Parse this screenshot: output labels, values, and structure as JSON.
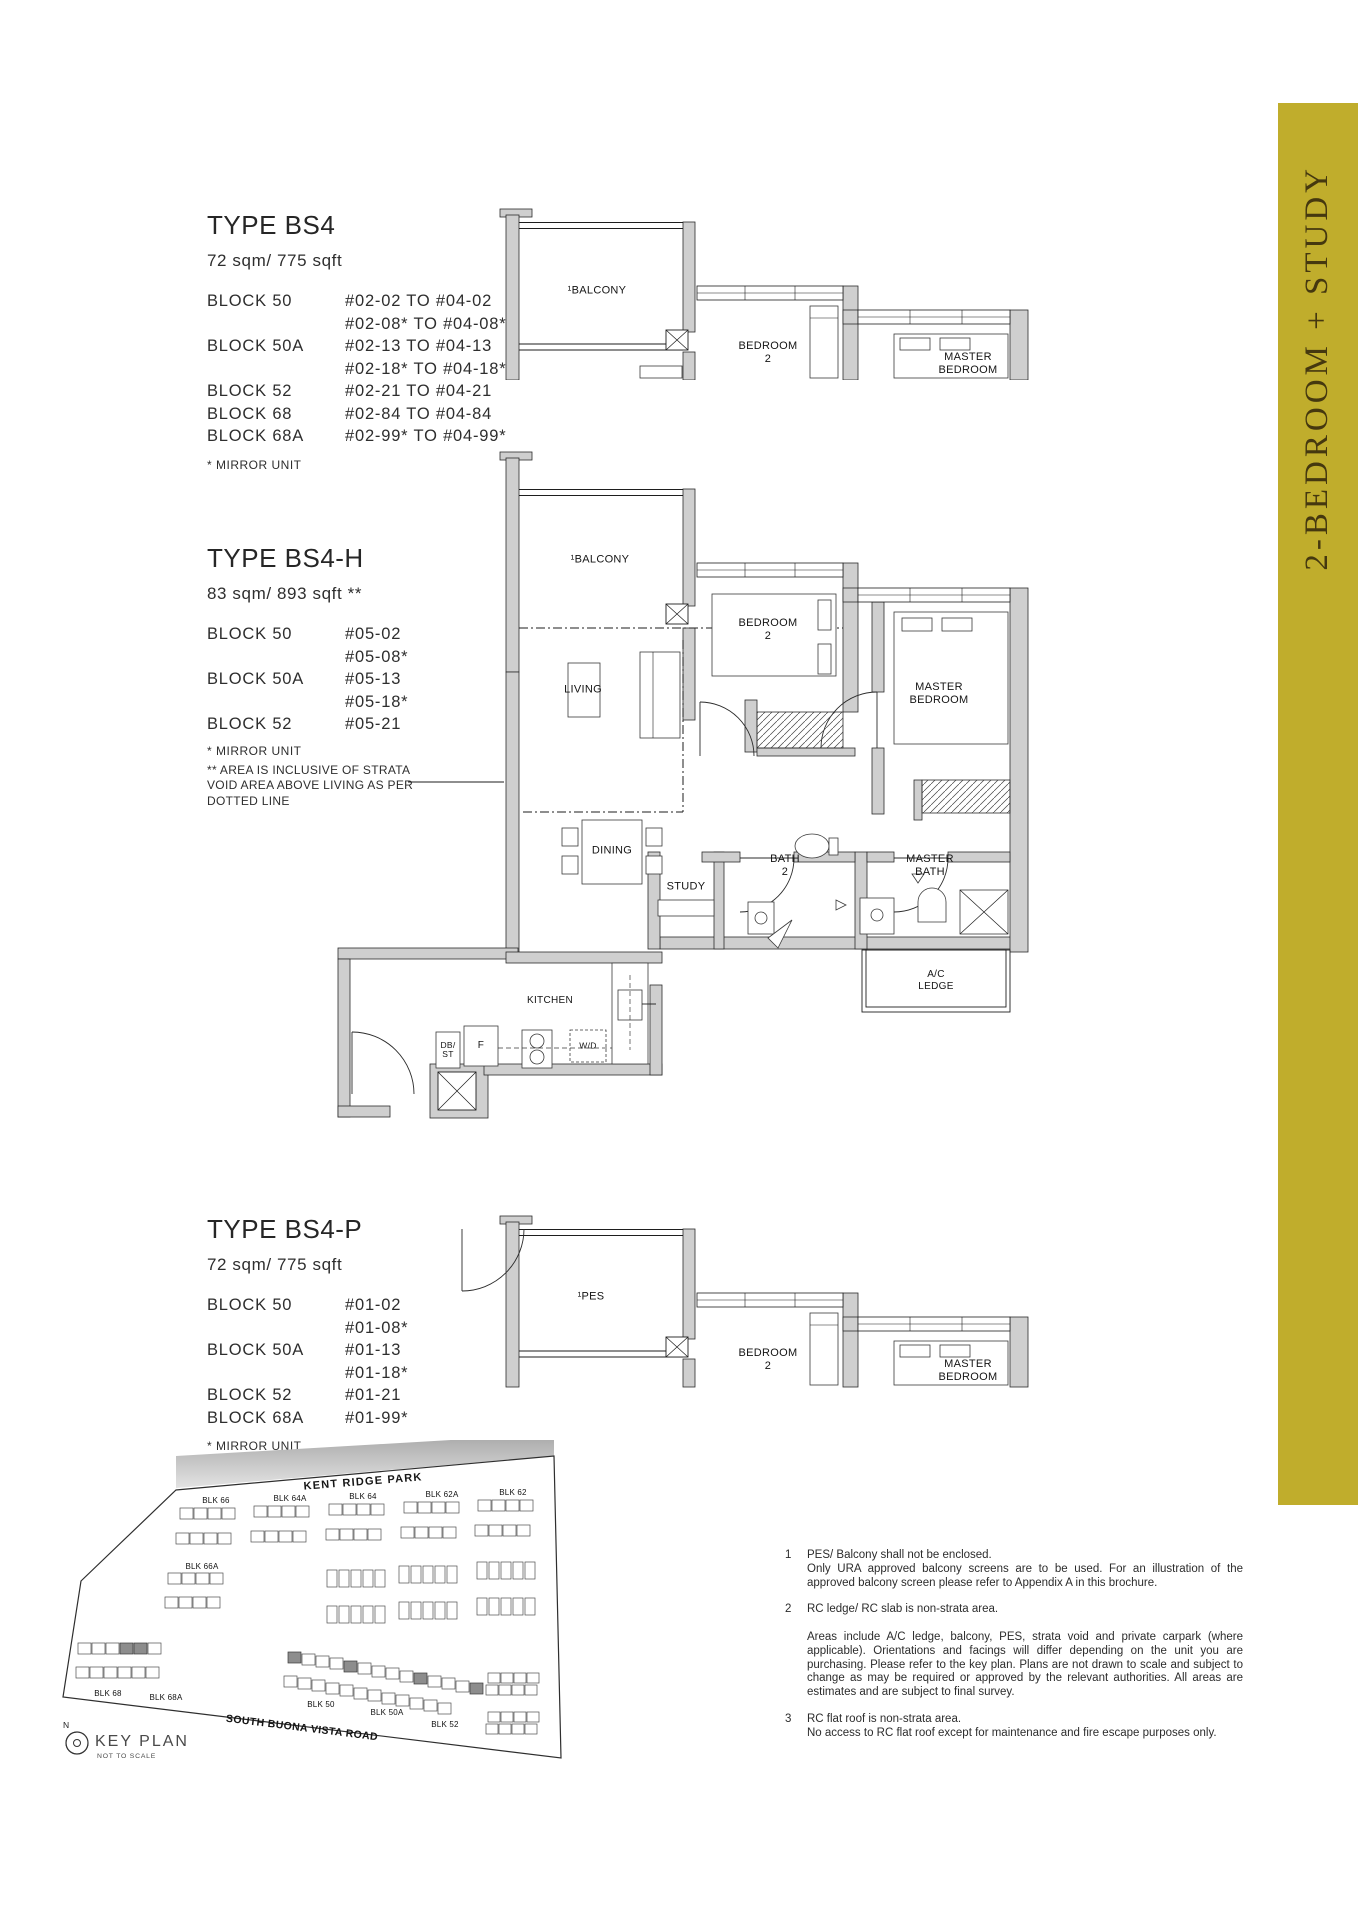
{
  "page": {
    "side_tab_label": "2-BEDROOM + STUDY",
    "colors": {
      "gold": "#c0ad2c",
      "gold_text": "#45380f",
      "wall_gray": "#cfcfcf"
    }
  },
  "sections": {
    "bs4": {
      "title": "TYPE BS4",
      "area": "72 sqm/ 775 sqft",
      "mirror": "* MIRROR UNIT",
      "rows": [
        {
          "block": "BLOCK 50",
          "unit": "#02-02 TO #04-02"
        },
        {
          "block": "",
          "unit": "#02-08* TO #04-08*"
        },
        {
          "block": "BLOCK 50A",
          "unit": "#02-13 TO #04-13"
        },
        {
          "block": "",
          "unit": "#02-18* TO #04-18*"
        },
        {
          "block": "BLOCK 52",
          "unit": "#02-21 TO #04-21"
        },
        {
          "block": "BLOCK 68",
          "unit": "#02-84 TO #04-84"
        },
        {
          "block": "BLOCK 68A",
          "unit": "#02-99* TO #04-99*"
        }
      ]
    },
    "bs4h": {
      "title": "TYPE BS4-H",
      "area": "83 sqm/ 893 sqft **",
      "mirror": "* MIRROR UNIT",
      "strata_note": "** AREA IS INCLUSIVE OF STRATA\nVOID AREA ABOVE LIVING AS PER\nDOTTED LINE",
      "rows": [
        {
          "block": "BLOCK 50",
          "unit": "#05-02"
        },
        {
          "block": "",
          "unit": "#05-08*"
        },
        {
          "block": "BLOCK 50A",
          "unit": "#05-13"
        },
        {
          "block": "",
          "unit": "#05-18*"
        },
        {
          "block": "BLOCK 52",
          "unit": "#05-21"
        }
      ]
    },
    "bs4p": {
      "title": "TYPE BS4-P",
      "area": "72 sqm/ 775 sqft",
      "mirror": "* MIRROR UNIT",
      "rows": [
        {
          "block": "BLOCK 50",
          "unit": "#01-02"
        },
        {
          "block": "",
          "unit": "#01-08*"
        },
        {
          "block": "BLOCK 50A",
          "unit": "#01-13"
        },
        {
          "block": "",
          "unit": "#01-18*"
        },
        {
          "block": "BLOCK 52",
          "unit": "#01-21"
        },
        {
          "block": "BLOCK 68A",
          "unit": "#01-99*"
        }
      ]
    }
  },
  "plans": {
    "top": {
      "balcony": "¹BALCONY",
      "bedroom2": "BEDROOM\n2",
      "master": "MASTER\nBEDROOM"
    },
    "mid": {
      "balcony": "¹BALCONY",
      "living": "LIVING",
      "bedroom2": "BEDROOM\n2",
      "master": "MASTER\nBEDROOM",
      "dining": "DINING",
      "study": "STUDY",
      "bath2": "BATH\n2",
      "master_bath": "MASTER\nBATH",
      "kitchen": "KITCHEN",
      "ac_ledge": "A/C\nLEDGE",
      "db_st": "DB/\nST",
      "fridge": "F",
      "wd": "W/D"
    },
    "bottom": {
      "pes": "¹PES",
      "bedroom2": "BEDROOM\n2",
      "master": "MASTER\nBEDROOM"
    }
  },
  "keyplan": {
    "park": "KENT RIDGE PARK",
    "road": "SOUTH BUONA VISTA ROAD",
    "title": "KEY PLAN",
    "subtitle": "NOT TO SCALE",
    "north": "N",
    "blocks": {
      "b66": "BLK 66",
      "b64a": "BLK 64A",
      "b64": "BLK 64",
      "b62a": "BLK 62A",
      "b62": "BLK 62",
      "b66a": "BLK 66A",
      "b68": "BLK 68",
      "b68a": "BLK 68A",
      "b50": "BLK 50",
      "b50a": "BLK 50A",
      "b52": "BLK 52"
    }
  },
  "notes": [
    {
      "num": "1",
      "line": "PES/ Balcony shall not be enclosed.",
      "para": "Only URA approved balcony screens are to be used. For an illustration of the approved balcony screen please refer to Appendix A in this brochure."
    },
    {
      "num": "2",
      "line": "RC ledge/ RC slab is non-strata area.",
      "para": "Areas include A/C ledge, balcony, PES, strata void and private carpark (where applicable). Orientations and facings will differ depending on the unit you are purchasing. Please refer to the key plan. Plans are not drawn to scale and subject to change as may be required or approved by the relevant authorities. All areas are estimates and are subject to final survey."
    },
    {
      "num": "3",
      "line": "RC flat roof is non-strata area.",
      "para": "No access to RC flat roof except for maintenance and fire escape purposes only."
    }
  ]
}
